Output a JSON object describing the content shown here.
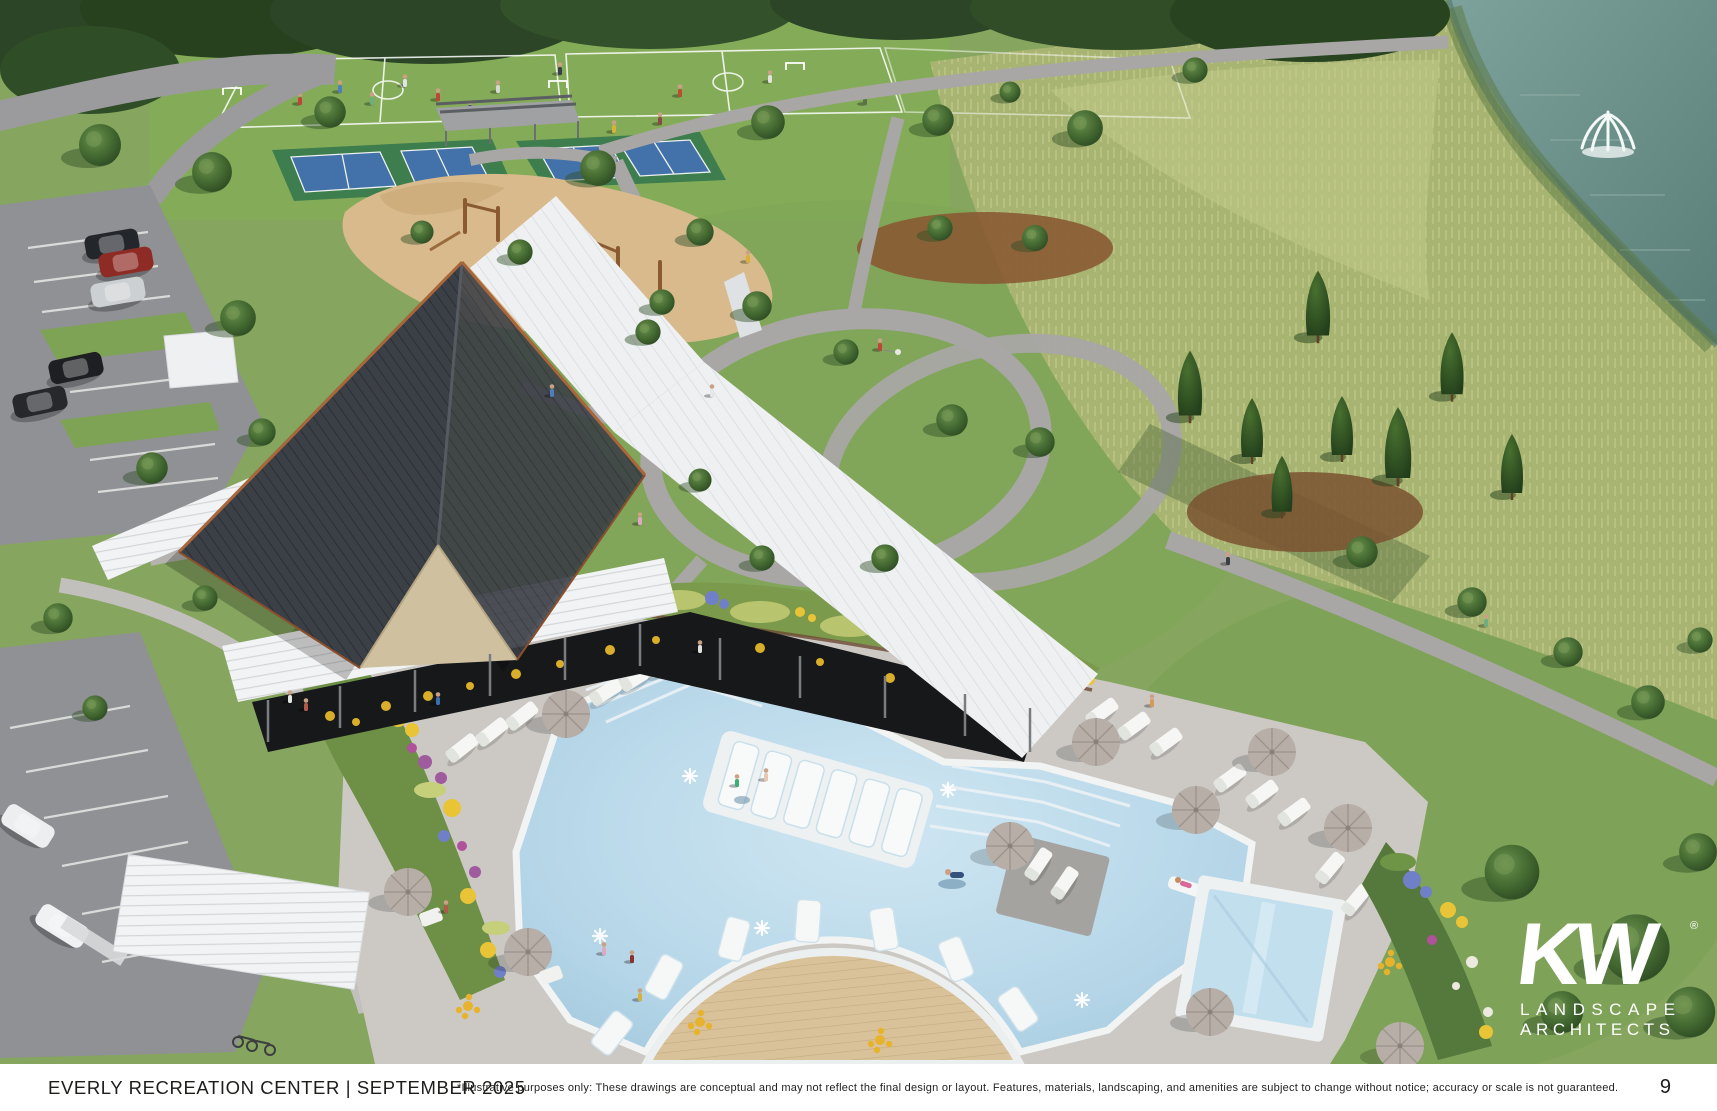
{
  "footer": {
    "title": "EVERLY RECREATION CENTER | SEPTEMBER 2025",
    "disclaimer": "*Illustrative purposes only: These drawings are conceptual and may not reflect the final design or layout. Features, materials, landscaping, and amenities are subject to change without notice; accuracy or scale is not guaranteed.",
    "page_number": "9"
  },
  "logo": {
    "mark": "KW",
    "registered": "®",
    "line1": "LANDSCAPE",
    "line2": "ARCHITECTS",
    "color": "#ffffff"
  },
  "scene": {
    "type": "aerial-architectural-rendering",
    "features": [
      "soccer-fields-with-players",
      "pickleball-courts",
      "shade-pavilion",
      "playground",
      "clubhouse-gabled-roof",
      "white-pergola-roofs",
      "open-air-pavilion-yellow-seating",
      "resort-pool-with-tanning-ledge",
      "in-pool-loungers",
      "curved-wood-deck",
      "square-plunge-pool",
      "pool-deck-chaise-lounges",
      "market-umbrellas",
      "walking-loop-paths",
      "central-lawn-oval",
      "meadow-grass",
      "pond-with-fountain",
      "pine-grove",
      "parking-lot-with-cars",
      "flower-beds",
      "street-trees",
      "people-walking",
      "dog-walker",
      "swimmers"
    ],
    "palette": {
      "lawn": "#86a55e",
      "field": "#84ad58",
      "meadow": "#a8b471",
      "canopy_dark": "#2b4526",
      "pond": "#64908a",
      "path_gray": "#a8a7a5",
      "asphalt": "#8f9194",
      "deck_concrete": "#ccc9c4",
      "pool_water": "#b9d8e9",
      "coping_white": "#f2f4f4",
      "roof_dark": "#3b3f46",
      "roof_trim": "#a9663a",
      "gable_tan": "#cfc0a0",
      "white_roof": "#eef0f2",
      "wood_deck": "#d9c29a",
      "sand": "#d8ba8c",
      "court_blue": "#4470b4",
      "court_green": "#3e7d4e",
      "flower_yellow": "#e9c436",
      "flower_purple": "#a05a9e",
      "flower_blue": "#7080c8",
      "furniture_yellow": "#e7b32c",
      "umbrella_taupe": "#b7aea8"
    }
  }
}
